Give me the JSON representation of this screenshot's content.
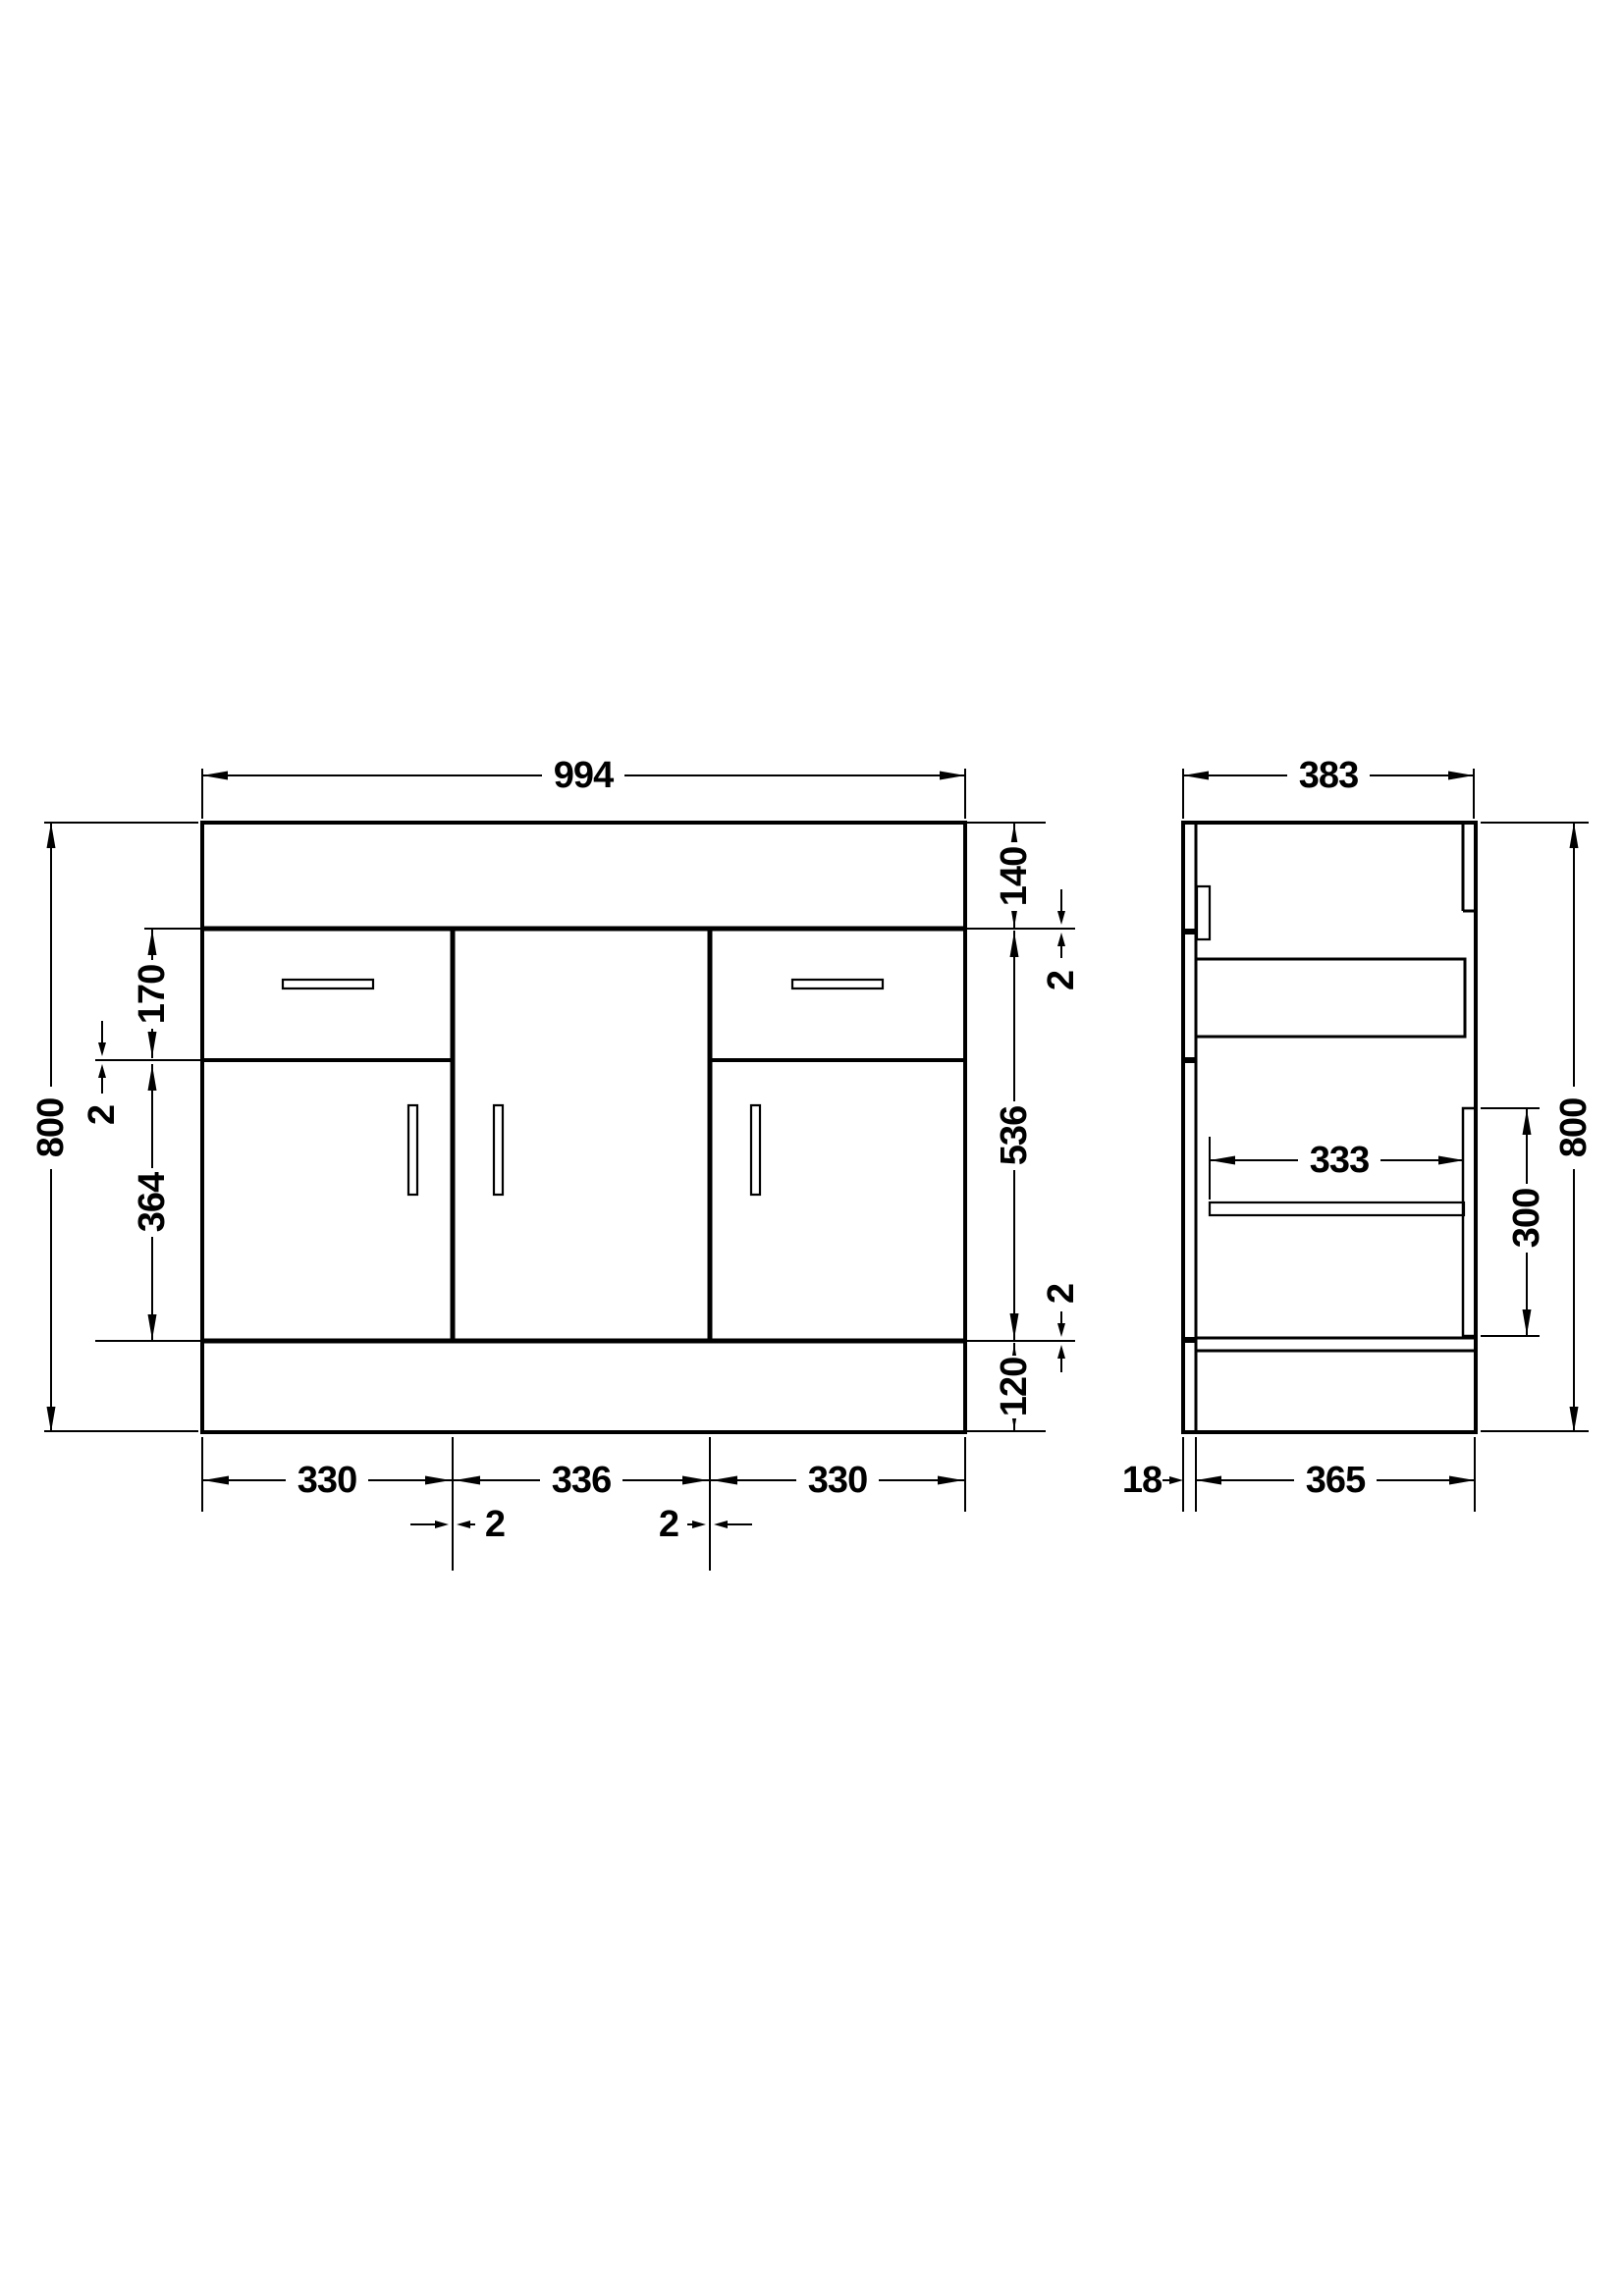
{
  "drawing": {
    "type": "technical-drawing",
    "subject": "vanity-unit-cabinet",
    "units": "mm",
    "colors": {
      "line": "#000000",
      "background": "#ffffff"
    },
    "front_view": {
      "dims": {
        "overall_width": "994",
        "overall_height": "800",
        "worktop_height": "140",
        "gap_top": "2",
        "drawer_front_height": "170",
        "gap_drawer_door": "2",
        "door_front_height": "364",
        "middle_section_height": "536",
        "gap_bottom": "2",
        "plinth_height": "120",
        "left_section_width": "330",
        "middle_section_width": "336",
        "right_section_width": "330",
        "gap_left_middle": "2",
        "gap_middle_right": "2"
      }
    },
    "side_view": {
      "dims": {
        "overall_depth": "383",
        "overall_height": "800",
        "shelf_depth": "333",
        "door_panel_height": "300",
        "back_panel_thickness": "18",
        "carcass_depth": "365"
      }
    }
  }
}
